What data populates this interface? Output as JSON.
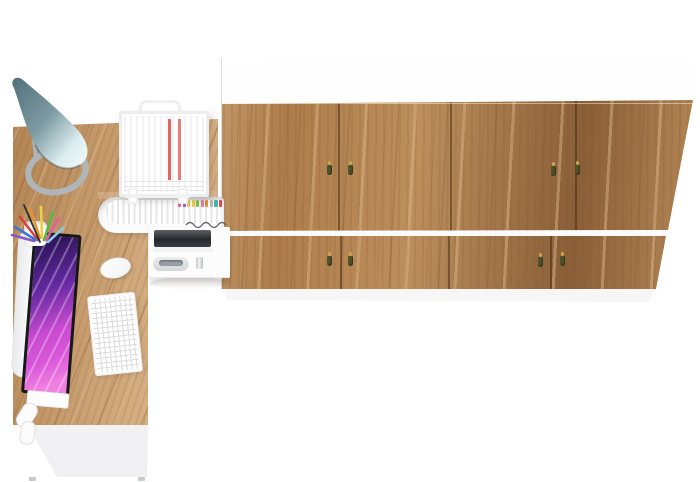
{
  "scene": {
    "label": "Top-down 3D render of a home office: L-shaped oak desk with an all-in-one computer, desk lamp, keyboard, mouse, pen cup, wire document tray, pull-out file drawer and mobile pedestal, beside a wall of eight oak wardrobe doors",
    "background": "#ffffff"
  },
  "colors": {
    "white": "#ffffff",
    "wood-base": "#bd8f5d",
    "wood-mid": "#ad7c4a",
    "wood-dark": "#8a5f38",
    "wood-light": "#d9b488",
    "cabinet-white": "#fdfdfd",
    "divider-white": "#fafafa",
    "seam-brown": "rgba(72,46,22,0.55)",
    "lamp-teal-dark": "#51707a",
    "lamp-teal-mid": "#7d9aa2",
    "lamp-teal-light": "#dceef0",
    "metal-gray": "#aeb6ba",
    "screen-deep-purple": "#2a1458",
    "screen-violet": "#6428a0",
    "screen-magenta": "#c84ad0",
    "screen-pink": "#f080e0",
    "bezel-black": "#17171a",
    "tassel-olive": "#4d5128",
    "tassel-gold": "#c9a94d",
    "handle-silver": "#9aa0a6",
    "paper-red": "#e0564f",
    "shadow-soft": "rgba(96,84,70,0.18)"
  },
  "cabinet": {
    "label": "oak wardrobe wall unit, white top band, two rows of doors",
    "door_rows": 2,
    "doors_per_row": 4,
    "handle_count": 8,
    "handle_style": "gold knob with olive tassel"
  },
  "desk": {
    "label": "L-shaped oak desk with white modesty panel",
    "items": [
      "desk-lamp",
      "pen-cup",
      "colored-pencils",
      "all-in-one-computer",
      "keyboard",
      "mouse",
      "document-wire-tray",
      "pull-out-file-tray",
      "mobile-pedestal"
    ]
  },
  "tab_colors": [
    "#e060a0",
    "#9b59d0",
    "#e8c840",
    "#f0d040",
    "#7ac850",
    "#e87ab0",
    "#e8903a",
    "#b8bcc0",
    "#40b8a8",
    "#d84a45"
  ],
  "pencil_colors": [
    "#d84040",
    "#e8952f",
    "#f0d040",
    "#58b84a",
    "#3a78d0",
    "#303030",
    "#e060a0",
    "#8858c8",
    "#8cc8e8"
  ]
}
